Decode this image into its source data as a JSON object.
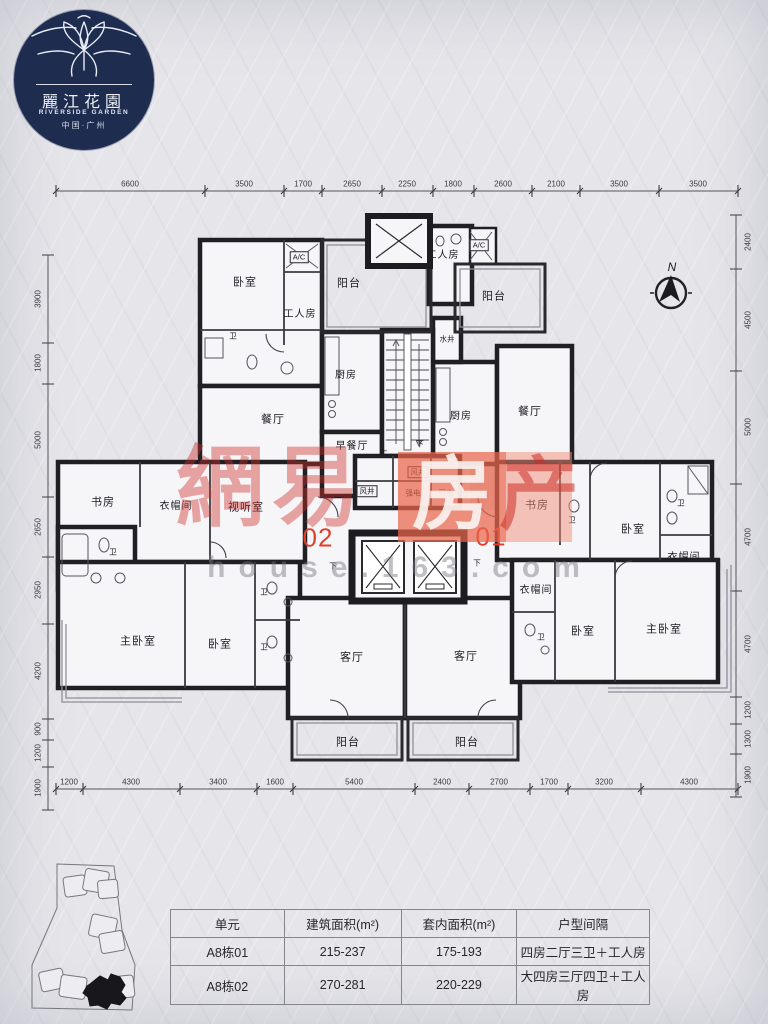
{
  "logo": {
    "name_cn": "麗江花園",
    "name_en": "RIVERSIDE GARDEN",
    "location": "中国·广州"
  },
  "compass_label": "N",
  "watermark": {
    "brand_left": "網易",
    "brand_char_fang": "房",
    "brand_char_chan": "产",
    "site": "house.163.com"
  },
  "unit_labels": {
    "left": "02",
    "right": "01"
  },
  "dimensions": {
    "top": [
      "6600",
      "3500",
      "1700",
      "2650",
      "2250",
      "1800",
      "2600",
      "2100",
      "3500",
      "3500"
    ],
    "bottom": [
      "1200",
      "4300",
      "3400",
      "1600",
      "5400",
      "2400",
      "2700",
      "1700",
      "3200",
      "4300"
    ],
    "left": [
      "3900",
      "1800",
      "5000",
      "2650",
      "2950",
      "4200",
      "900",
      "1200",
      "1900"
    ],
    "right": [
      "2400",
      "4500",
      "5000",
      "4700",
      "4700",
      "1200",
      "1300",
      "1900"
    ]
  },
  "rooms": [
    "卧室",
    "A/C",
    "工人房",
    "阳台",
    "卫",
    "厨房",
    "餐厅",
    "早餐厅",
    "工人房",
    "A/C",
    "阳台",
    "水井",
    "厨房",
    "餐厅",
    "风井",
    "风井",
    "强电",
    "弱电",
    "书房",
    "衣帽间",
    "视听室",
    "卫",
    "主卧室",
    "卧室",
    "卫",
    "卫",
    "客厅",
    "阳台",
    "书房",
    "卫",
    "卧室",
    "卫",
    "衣帽间",
    "衣帽间",
    "卫",
    "卧室",
    "主卧室",
    "客厅",
    "阳台",
    "上",
    "下",
    "下",
    "下"
  ],
  "table": {
    "headers": [
      "单元",
      "建筑面积(m²)",
      "套内面积(m²)",
      "户型间隔"
    ],
    "rows": [
      [
        "A8栋01",
        "215-237",
        "175-193",
        "四房二厅三卫＋工人房"
      ],
      [
        "A8栋02",
        "270-281",
        "220-229",
        "大四房三厅四卫＋工人房"
      ]
    ]
  }
}
